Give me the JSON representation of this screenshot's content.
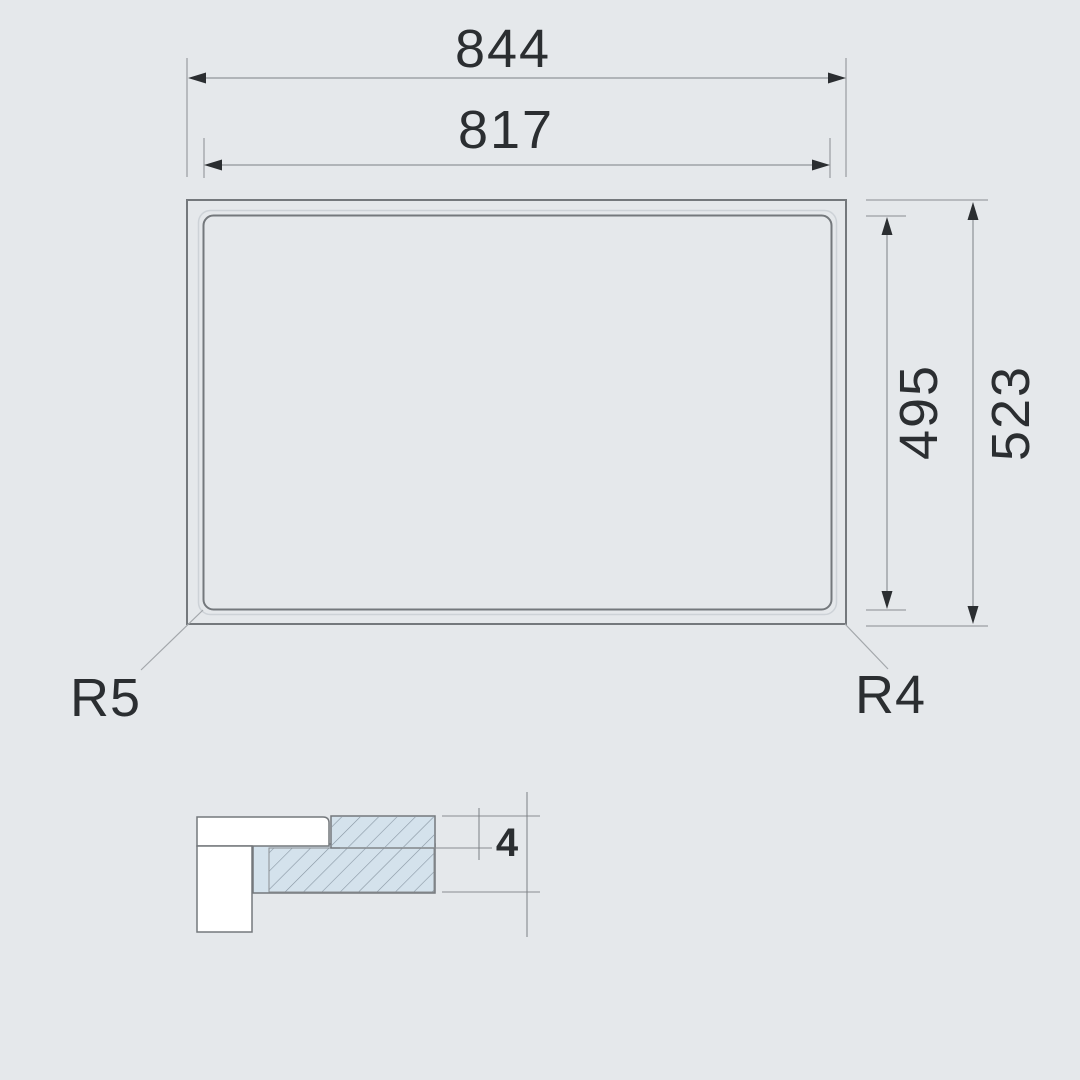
{
  "plan_view": {
    "dim_outer_width": "844",
    "dim_inner_width": "817",
    "dim_inner_height": "495",
    "dim_outer_height": "523",
    "radius_bottom_left": "R5",
    "radius_bottom_right": "R4"
  },
  "section_view": {
    "dim_thickness": "4"
  },
  "colors": {
    "background": "#e5e8eb",
    "outline": "#74787c",
    "dimension_line": "#7c8084",
    "leader_line": "#a3a7ab",
    "text": "#2b2e31",
    "section_fill": "#d4e2ec",
    "hatch_line": "#8795a1",
    "surface_white": "#ffffff"
  }
}
